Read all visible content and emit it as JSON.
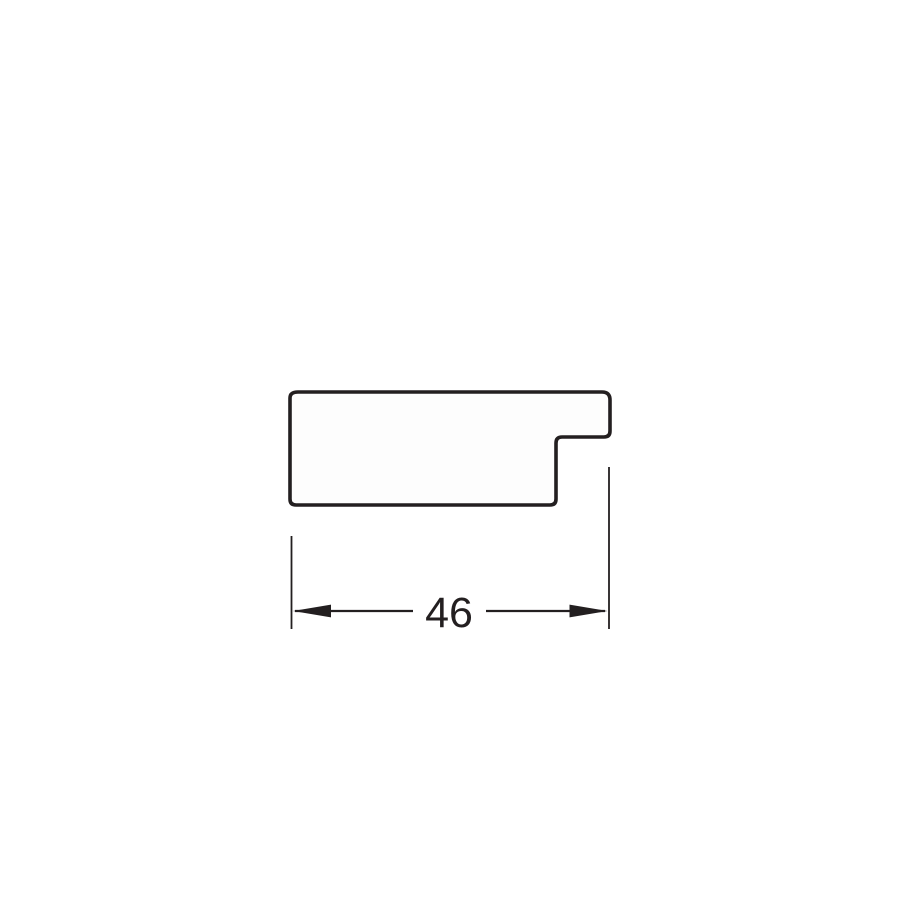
{
  "drawing": {
    "title": "Moulding profile cross-section drawing",
    "dimension": {
      "label": "46"
    },
    "colors": {
      "line": "#231f20",
      "fill": "#fdfdfd",
      "background": "#ffffff"
    }
  }
}
